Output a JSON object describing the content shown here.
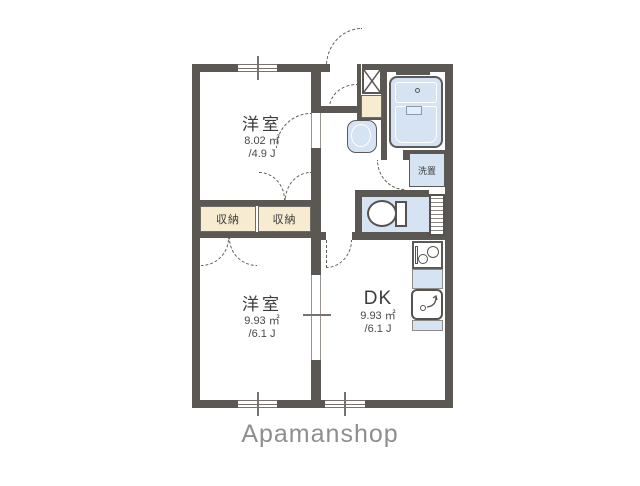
{
  "plan": {
    "rooms": {
      "bedroom_top": {
        "name": "洋室",
        "area_m2": "8.02 ㎡",
        "area_jo": "/4.9 J"
      },
      "bedroom_bottom": {
        "name": "洋室",
        "area_m2": "9.93 ㎡",
        "area_jo": "/6.1 J"
      },
      "dining_kitchen": {
        "name": "DK",
        "area_m2": "9.93 ㎡",
        "area_jo": "/6.1 J"
      },
      "closet_left": {
        "name": "収納"
      },
      "closet_right": {
        "name": "収納"
      },
      "laundry_space": {
        "name": "洗置"
      }
    },
    "fixture_names": [
      "bathtub",
      "washbasin",
      "toilet",
      "washing-machine-pan",
      "shoe-cabinet",
      "stove",
      "kitchen-sink",
      "pipe-space"
    ]
  },
  "footer": {
    "brand": "Apamanshop"
  },
  "colors": {
    "wall": "#5b5753",
    "water_fixture_fill": "#d5e3f3",
    "closet_fill": "#f7ebd2",
    "brand_text": "#8e8e8e",
    "line": "#5f5b58"
  }
}
